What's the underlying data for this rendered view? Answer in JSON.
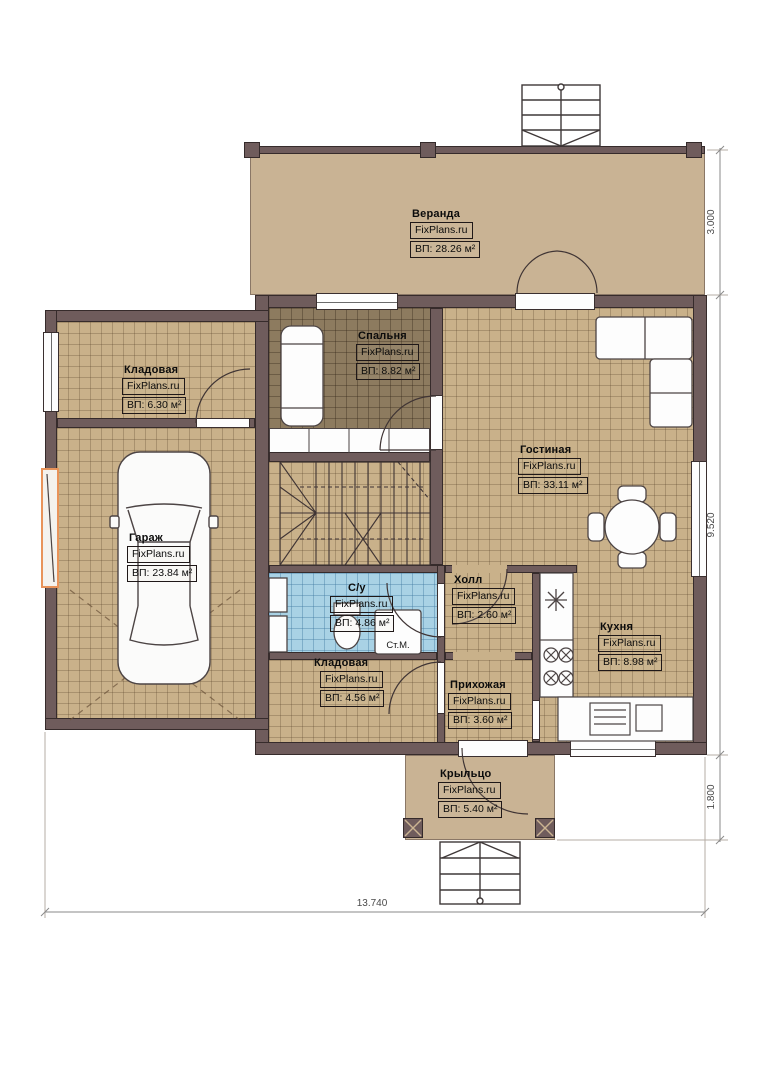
{
  "plan": {
    "brand": "FixPlans.ru",
    "rooms": [
      {
        "id": "veranda",
        "name": "Веранда",
        "area": "ВП: 28.26 м²"
      },
      {
        "id": "bedroom",
        "name": "Спальня",
        "area": "ВП: 8.82 м²"
      },
      {
        "id": "storage-top",
        "name": "Кладовая",
        "area": "ВП: 6.30 м²"
      },
      {
        "id": "living",
        "name": "Гостиная",
        "area": "ВП: 33.11 м²"
      },
      {
        "id": "garage",
        "name": "Гараж",
        "area": "ВП: 23.84 м²"
      },
      {
        "id": "bathroom",
        "name": "С/у",
        "area": "ВП: 4.86 м²"
      },
      {
        "id": "hall",
        "name": "Холл",
        "area": "ВП: 2.60 м²"
      },
      {
        "id": "kitchen",
        "name": "Кухня",
        "area": "ВП: 8.98 м²"
      },
      {
        "id": "storage-bottom",
        "name": "Кладовая",
        "area": "ВП: 4.56 м²"
      },
      {
        "id": "entry",
        "name": "Прихожая",
        "area": "ВП: 3.60 м²"
      },
      {
        "id": "porch",
        "name": "Крыльцо",
        "area": "ВП: 5.40 м²"
      }
    ],
    "annotations": {
      "washing_machine": "Ст.М."
    },
    "dimensions": {
      "right_top": "3.000",
      "right_middle": "9.520",
      "right_bottom": "1.800",
      "bottom": "13.740"
    },
    "colors": {
      "wall": "#6f5c5c",
      "floor_tile": "#c9b18a",
      "floor_veranda": "#c9b394",
      "floor_bedroom": "#8d7b5f",
      "floor_bathroom": "#a9d2e5",
      "garage_door_accent": "#e8935a"
    }
  }
}
